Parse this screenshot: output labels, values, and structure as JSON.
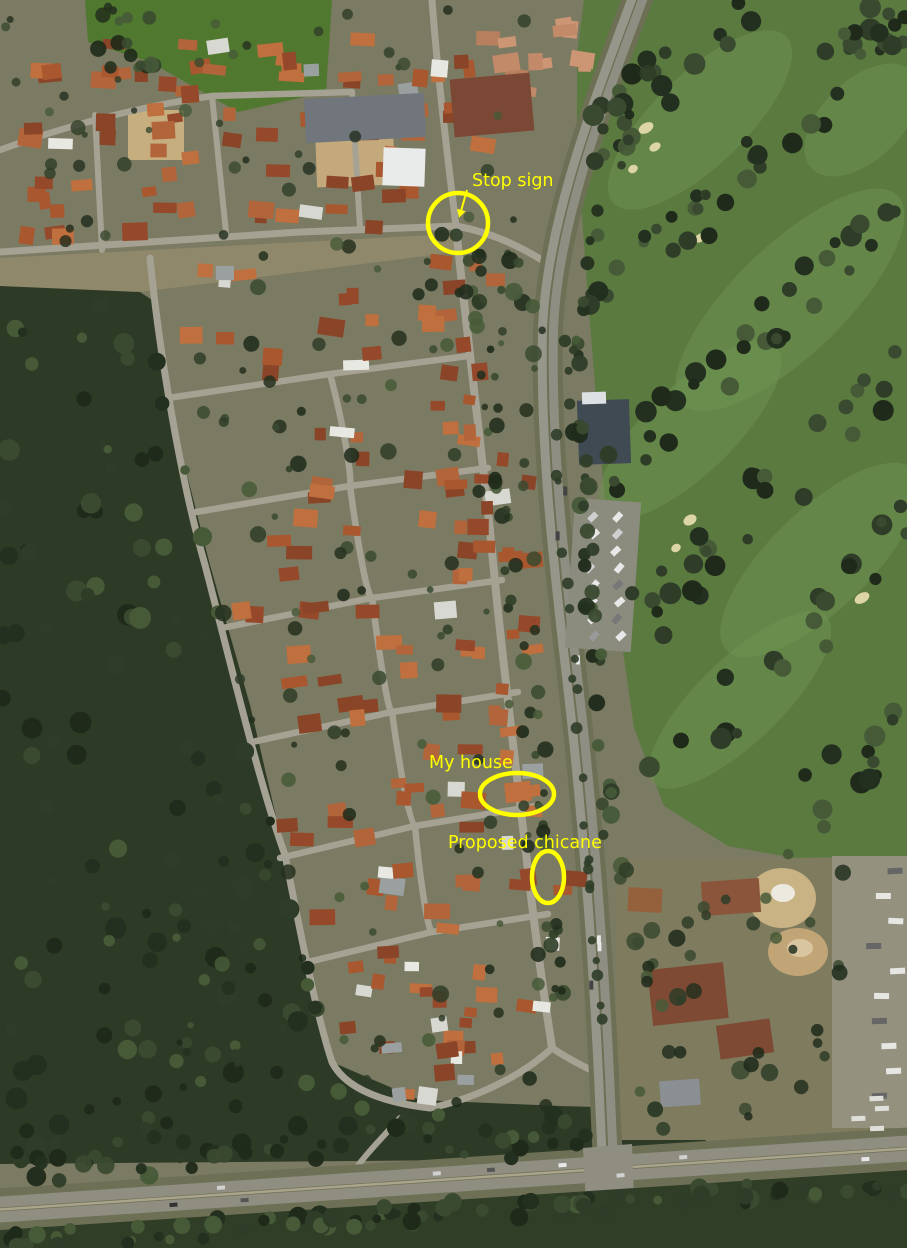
{
  "image": {
    "kind": "aerial-satellite-photo",
    "width": 907,
    "height": 1248,
    "scene": "suburban neighbourhood beside bushland, golf course and highway"
  },
  "colors": {
    "annotation": "#ffff00",
    "ground": "#7b7a62",
    "forest": "#2d3a26",
    "golf_green": "#5a7a40",
    "fairway": "#6d9150",
    "field": "#50782f",
    "road": "#a5a294",
    "arterial": "#97968a",
    "roof_terracotta": "#a8572f",
    "roof_white": "#e8e8e2",
    "sand": "#c9b283",
    "bunker": "#ddd5a6"
  },
  "annotations": {
    "color": "#ffff00",
    "items": [
      {
        "id": "stop-sign",
        "label": "Stop sign",
        "label_x": 472,
        "label_y": 186,
        "shape": "circle",
        "cx": 458,
        "cy": 223,
        "rx": 30,
        "ry": 30,
        "stroke_width": 4.5,
        "arrow": {
          "x1": 467,
          "y1": 190,
          "x2": 461,
          "y2": 211
        }
      },
      {
        "id": "my-house",
        "label": "My house",
        "label_x": 429,
        "label_y": 768,
        "shape": "ellipse",
        "cx": 517,
        "cy": 794,
        "rx": 37,
        "ry": 21,
        "stroke_width": 4.5
      },
      {
        "id": "proposed-chicane",
        "label": "Proposed chicane",
        "label_x": 448,
        "label_y": 848,
        "shape": "ellipse",
        "cx": 548,
        "cy": 877,
        "rx": 16,
        "ry": 26,
        "stroke_width": 4.5
      }
    ]
  }
}
